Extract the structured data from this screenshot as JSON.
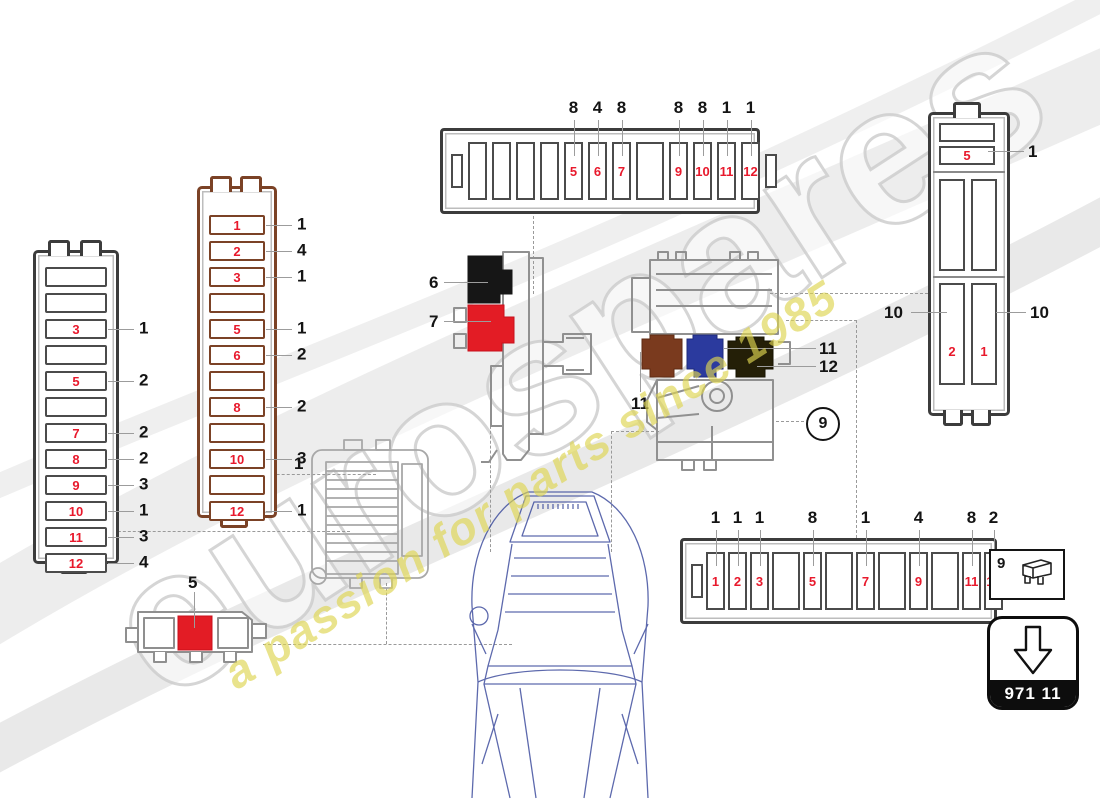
{
  "watermark": {
    "brand": "eurospares",
    "tagline": "a passion for parts since 1985"
  },
  "part_box": {
    "code": "971 11"
  },
  "legend_box": {
    "ref": "9"
  },
  "fusebox_left": {
    "slots": [
      {
        "num": "",
        "callout": ""
      },
      {
        "num": "",
        "callout": ""
      },
      {
        "num": "3",
        "callout": "1"
      },
      {
        "num": "",
        "callout": ""
      },
      {
        "num": "5",
        "callout": "2"
      },
      {
        "num": "",
        "callout": ""
      },
      {
        "num": "7",
        "callout": "2"
      },
      {
        "num": "8",
        "callout": "2"
      },
      {
        "num": "9",
        "callout": "3"
      },
      {
        "num": "10",
        "callout": "1"
      },
      {
        "num": "11",
        "callout": "3"
      },
      {
        "num": "12",
        "callout": "4"
      }
    ]
  },
  "fusebox_brown": {
    "slots": [
      {
        "num": "1",
        "callout": "1"
      },
      {
        "num": "2",
        "callout": "4"
      },
      {
        "num": "3",
        "callout": "1"
      },
      {
        "num": "",
        "callout": ""
      },
      {
        "num": "5",
        "callout": "1"
      },
      {
        "num": "6",
        "callout": "2"
      },
      {
        "num": "",
        "callout": ""
      },
      {
        "num": "8",
        "callout": "2"
      },
      {
        "num": "",
        "callout": ""
      },
      {
        "num": "10",
        "callout": "3"
      },
      {
        "num": "",
        "callout": ""
      },
      {
        "num": "12",
        "callout": "1"
      }
    ]
  },
  "fusebox_top": {
    "slots": [
      {
        "num": "",
        "callout": ""
      },
      {
        "num": "",
        "callout": ""
      },
      {
        "num": "",
        "callout": ""
      },
      {
        "num": "",
        "callout": ""
      },
      {
        "num": "5",
        "callout": "8"
      },
      {
        "num": "6",
        "callout": "4"
      },
      {
        "num": "7",
        "callout": "8"
      },
      {
        "num": "",
        "callout": ""
      },
      {
        "num": "9",
        "callout": "8"
      },
      {
        "num": "10",
        "callout": "8"
      },
      {
        "num": "11",
        "callout": "1"
      },
      {
        "num": "12",
        "callout": "1"
      }
    ]
  },
  "fusebox_bottom": {
    "slots": [
      {
        "num": "1",
        "callout": "1"
      },
      {
        "num": "2",
        "callout": "1"
      },
      {
        "num": "3",
        "callout": "1"
      },
      {
        "num": "",
        "callout": ""
      },
      {
        "num": "5",
        "callout": "8"
      },
      {
        "num": "",
        "callout": ""
      },
      {
        "num": "7",
        "callout": "1"
      },
      {
        "num": "",
        "callout": ""
      },
      {
        "num": "9",
        "callout": "4"
      },
      {
        "num": "",
        "callout": ""
      },
      {
        "num": "11",
        "callout": "8"
      },
      {
        "num": "12",
        "callout": "2"
      }
    ]
  },
  "fusebox_right": {
    "top_slot_num": "5",
    "top_callout": "1",
    "bottom_left_num": "2",
    "bottom_left_callout": "10",
    "bottom_right_num": "1",
    "bottom_right_callout": "10"
  },
  "relay_holder": {
    "black_relay_callout": "6",
    "red_relay_callout": "7"
  },
  "relay_assembly": {
    "brown_relay_callout": "11",
    "blue_relay_callout": "11",
    "dark_relay_callout": "12",
    "circled_ref": "9"
  },
  "ecu_holder": {
    "callout": "1"
  },
  "small_box": {
    "callout": "5"
  },
  "colors": {
    "accent_red": "#e8192c",
    "relay_black": "#161616",
    "relay_red": "#e31c25",
    "relay_brown": "#7a3a1e",
    "relay_blue": "#2b3a9e",
    "relay_dark_olive": "#241f07",
    "brown_outline": "#7b4226",
    "car_blue": "#41509f",
    "watermark_yellow": "#ded550"
  }
}
